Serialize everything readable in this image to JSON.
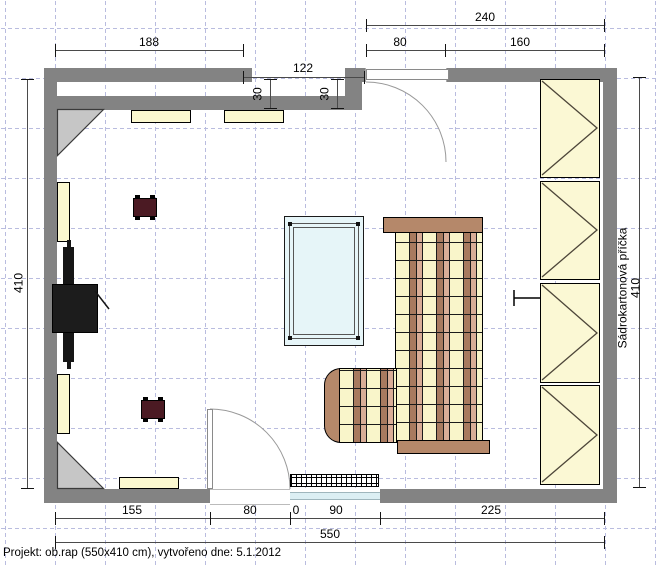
{
  "app": {
    "type": "floor-plan-canvas"
  },
  "room": {
    "width_cm": "550",
    "height_cm": "410"
  },
  "dims": {
    "top_total": "240",
    "top_188": "188",
    "top_door": "80",
    "top_160": "160",
    "recess_width": "122",
    "recess_depth_left": "30",
    "recess_depth_right": "30",
    "left_height": "410",
    "right_partition_label": "Sádrokartonová příčka",
    "right_height": "410",
    "bottom_155": "155",
    "bottom_door": "80",
    "bottom_zero": "0",
    "bottom_window": "90",
    "bottom_225": "225",
    "bottom_total": "550"
  },
  "footer": {
    "project_info": "Projekt: ob.rap (550x410 cm), vytvořeno dne: 5.1.2012"
  },
  "furniture_icons": [
    "corner-desk-icon",
    "wall-shelf-icon",
    "speaker-icon",
    "keyboard-piano-icon",
    "glass-table-icon",
    "bed-icon",
    "chaise-icon",
    "wardrobe-icon",
    "radiator-icon",
    "door-icon",
    "window-icon"
  ],
  "colors": {
    "wall": "#838383",
    "grid": "#b9bcdf",
    "shelf": "#FBF8D0",
    "wardrobe": "#FBF8D4",
    "bed_frame": "#B5886A",
    "plaid_brown": "#A87A5F",
    "plaid_tan": "#D9AD97",
    "plaid_cream": "#F9F5CA",
    "speaker": "#4B1A23",
    "table_glass": "#E6F5F8"
  }
}
